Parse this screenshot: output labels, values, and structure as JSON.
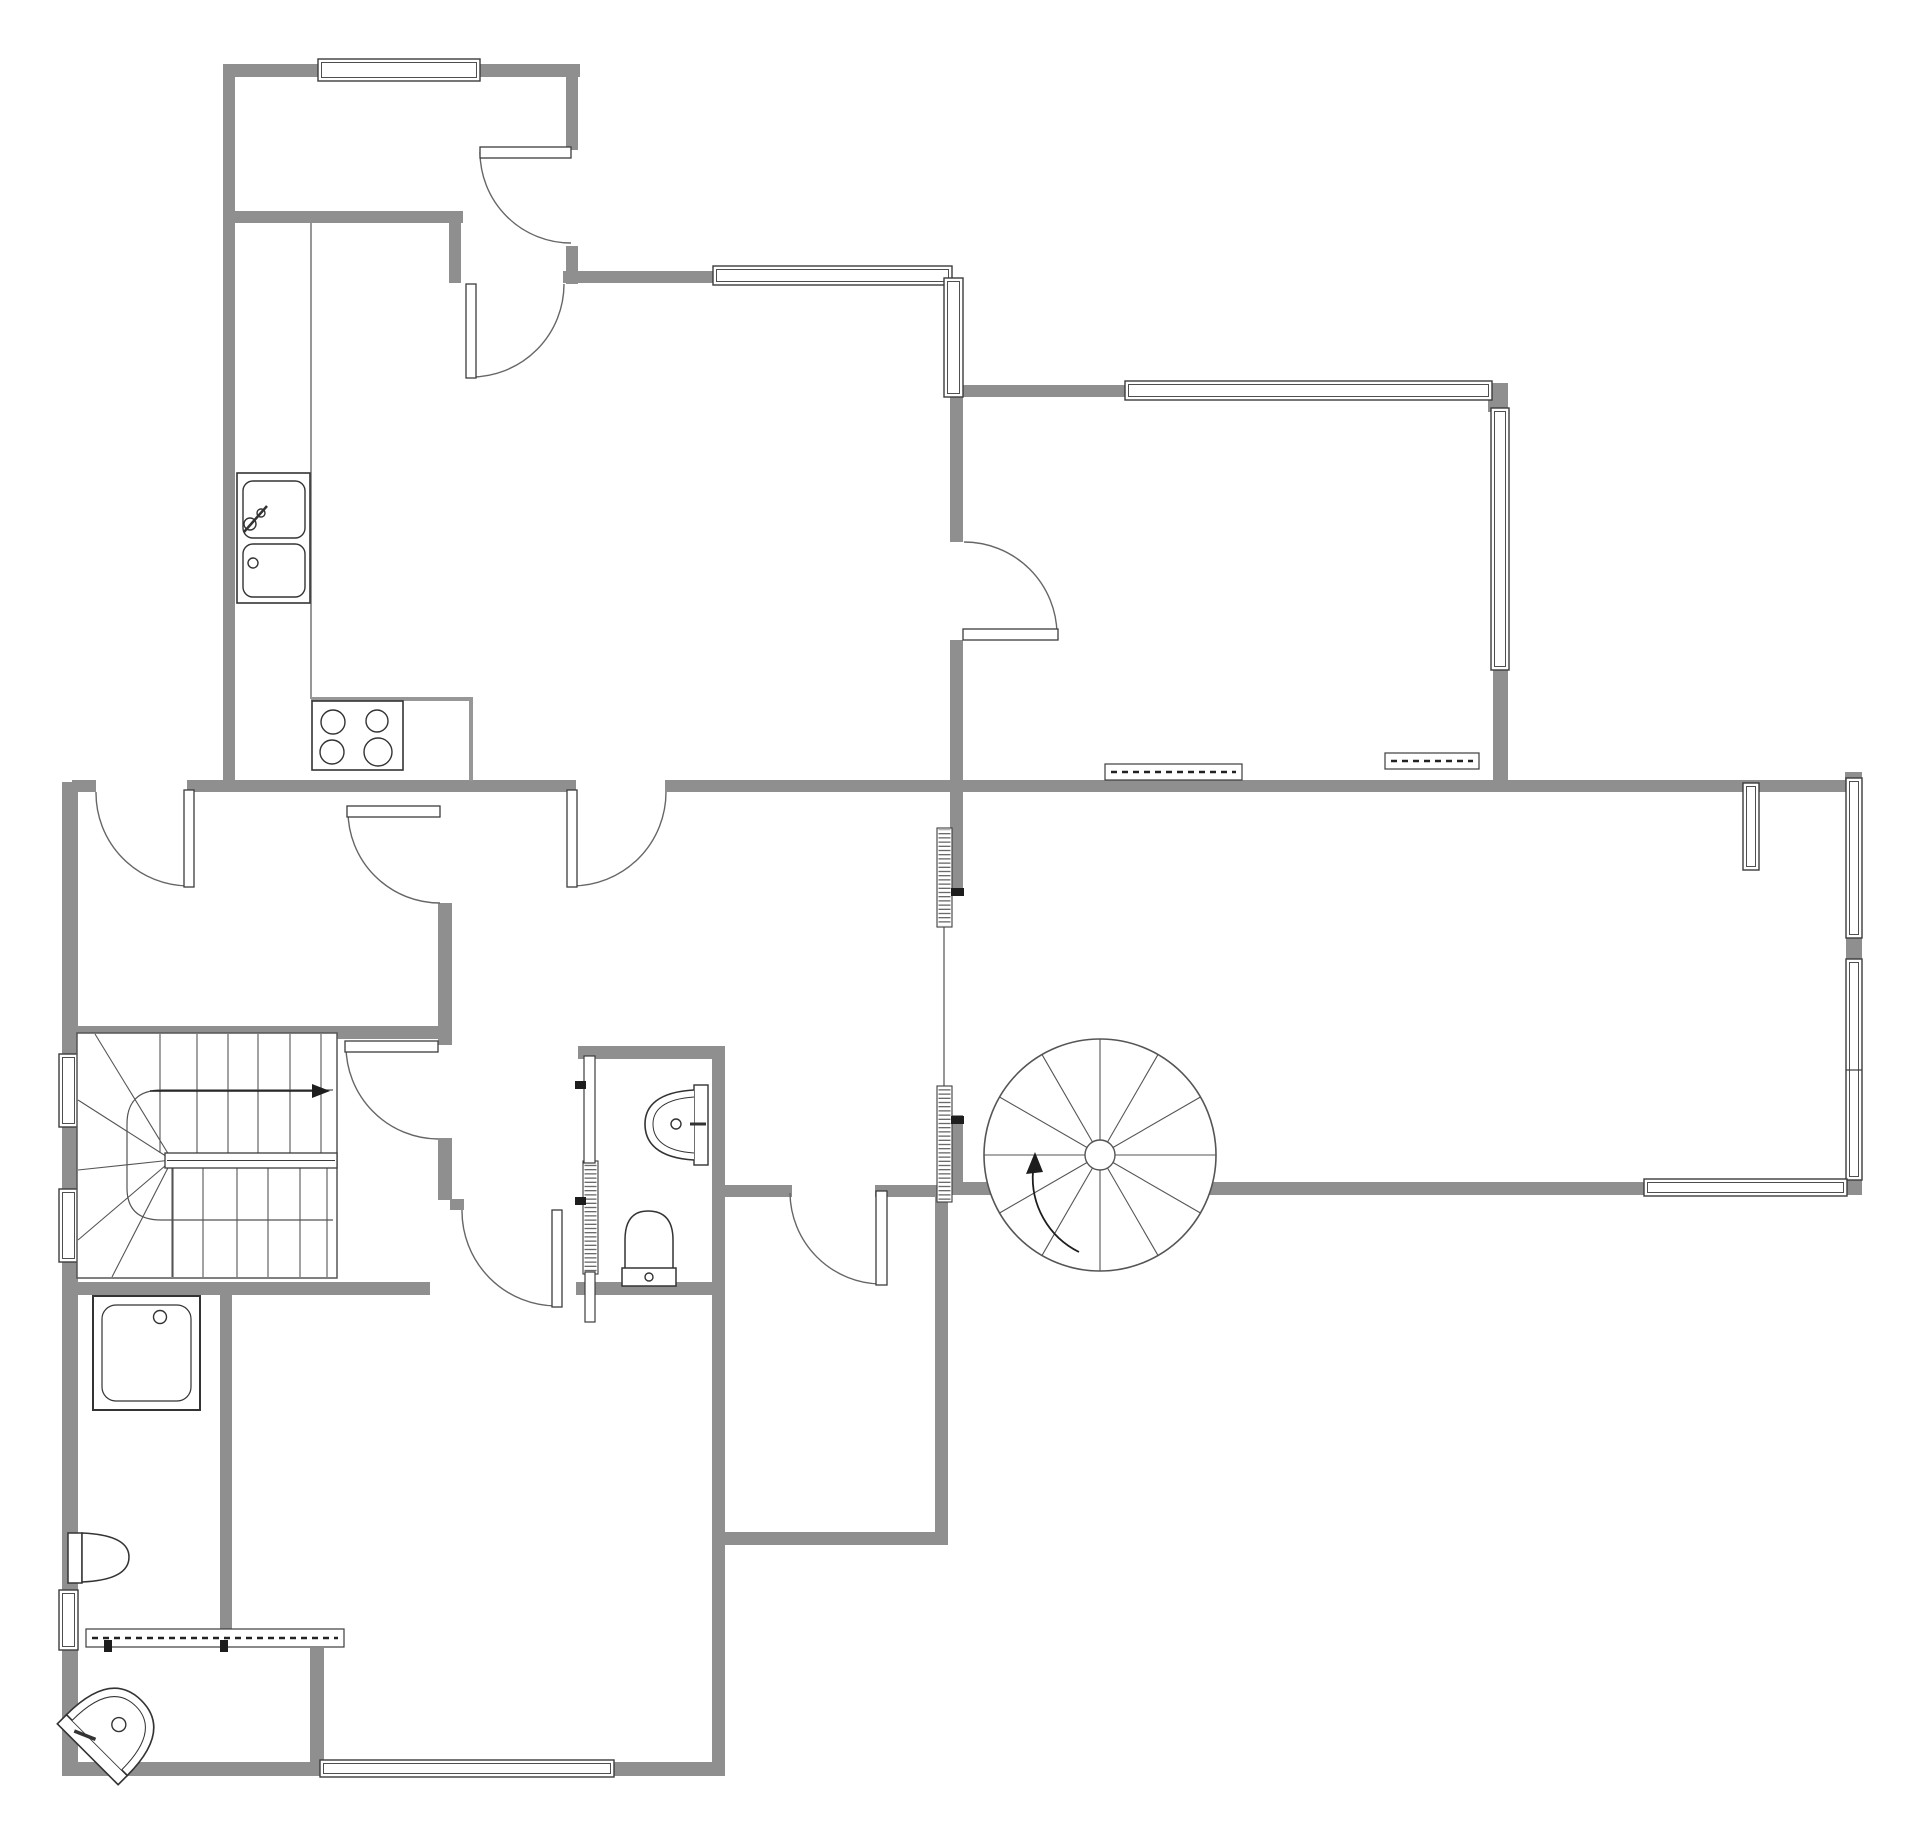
{
  "meta": {
    "title": "floor-plan",
    "canvas": {
      "width": 1920,
      "height": 1840,
      "background": "#ffffff"
    },
    "colors": {
      "wall": "#8f8f8f",
      "outline": "#3c3c3c",
      "swing": "#666666",
      "thin": "#979797",
      "fixture": "#333333",
      "mark": "#1d1d1d"
    }
  },
  "plan": {
    "walls": [
      [
        "wall-topleft-top",
        223,
        64,
        357,
        13
      ],
      [
        "wall-entry-south",
        223,
        211,
        240,
        12
      ],
      [
        "wall-kitchen-north",
        563,
        271,
        155,
        12
      ],
      [
        "wall-topright-north",
        947,
        385,
        180,
        12
      ],
      [
        "wall-mid-west-stub",
        72,
        780,
        24,
        12
      ],
      [
        "wall-mid-main",
        187,
        780,
        389,
        12
      ],
      [
        "wall-mid-east",
        665,
        780,
        1191,
        12
      ],
      [
        "wall-stair-north",
        62,
        1026,
        390,
        13
      ],
      [
        "wall-bath-north",
        578,
        1046,
        147,
        13
      ],
      [
        "wall-bigroom-south",
        948,
        1182,
        908,
        13
      ],
      [
        "wall-strip-south-a",
        718,
        1185,
        74,
        12
      ],
      [
        "wall-strip-south-b",
        875,
        1185,
        75,
        12
      ],
      [
        "wall-stair-south",
        62,
        1282,
        368,
        13
      ],
      [
        "wall-bath-south",
        576,
        1282,
        149,
        13
      ],
      [
        "wall-midroom-south",
        712,
        1532,
        236,
        13
      ],
      [
        "wall-bottom-west",
        62,
        1762,
        262,
        14
      ],
      [
        "wall-bottom-east",
        608,
        1762,
        116,
        14
      ],
      [
        "wall-corridor-stub",
        450,
        1199,
        14,
        11
      ],
      [
        "wall-kitchen-west",
        223,
        64,
        12,
        728
      ],
      [
        "wall-entry-east-a",
        566,
        64,
        12,
        86
      ],
      [
        "wall-entry-east-b",
        566,
        246,
        12,
        38
      ],
      [
        "wall-entry-corner",
        449,
        211,
        12,
        72
      ],
      [
        "wall-kitchen-east-a",
        950,
        395,
        13,
        147
      ],
      [
        "wall-kitchen-east-b",
        950,
        640,
        13,
        255
      ],
      [
        "wall-bigroom-west-low",
        950,
        1115,
        13,
        75
      ],
      [
        "wall-topright-ne-corner",
        1488,
        383,
        20,
        29
      ],
      [
        "wall-topright-east",
        1493,
        668,
        15,
        124
      ],
      [
        "wall-bigroom-ne-corner",
        1845,
        772,
        17,
        10
      ],
      [
        "wall-bigroom-east-a",
        1846,
        936,
        16,
        27
      ],
      [
        "wall-bigroom-east-b",
        1846,
        1176,
        16,
        19
      ],
      [
        "wall-west-a",
        62,
        782,
        16,
        276
      ],
      [
        "wall-west-b",
        62,
        1123,
        16,
        70
      ],
      [
        "wall-west-c",
        62,
        1258,
        16,
        336
      ],
      [
        "wall-west-d",
        62,
        1644,
        16,
        132
      ],
      [
        "wall-hall-east-a",
        438,
        903,
        14,
        142
      ],
      [
        "wall-hall-east-b",
        438,
        1138,
        14,
        62
      ],
      [
        "wall-rooms-divider",
        712,
        1046,
        13,
        730
      ],
      [
        "wall-midroom-east",
        935,
        1193,
        13,
        352
      ],
      [
        "wall-wc-east",
        220,
        1288,
        12,
        342
      ],
      [
        "wall-sinkroom-east",
        310,
        1648,
        14,
        128
      ]
    ],
    "thin_lines": [
      [
        "kitchen-zone-line",
        311,
        223,
        311,
        699,
        2
      ],
      [
        "bigroom-west-line",
        944,
        925,
        944,
        1087,
        2
      ]
    ],
    "counter_path": {
      "name": "kitchen-counter",
      "d": "M311,699 H471 V781",
      "sw": 4
    },
    "windows": [
      [
        "window-entry-north",
        318,
        59,
        162,
        22
      ],
      [
        "window-kitchen-north",
        713,
        266,
        239,
        19
      ],
      [
        "window-kitchen-east",
        944,
        278,
        19,
        119
      ],
      [
        "window-topright-north",
        1125,
        381,
        367,
        19
      ],
      [
        "window-topright-east",
        1491,
        408,
        18,
        262
      ],
      [
        "window-bigroom-east-1",
        1846,
        778,
        16,
        160
      ],
      [
        "window-bigroom-east-2",
        1846,
        959,
        16,
        221
      ],
      [
        "window-bigroom-south",
        1644,
        1179,
        203,
        17
      ],
      [
        "window-west-1",
        59,
        1054,
        19,
        73
      ],
      [
        "window-west-2",
        59,
        1189,
        19,
        73
      ],
      [
        "window-west-3",
        59,
        1590,
        19,
        60
      ],
      [
        "window-bottom",
        320,
        1760,
        294,
        17
      ],
      [
        "window-bigroom-radiator",
        1743,
        783,
        16,
        87
      ]
    ],
    "dashed_windows": [
      [
        "radiator-topright-1",
        1105,
        764,
        137,
        16
      ],
      [
        "radiator-topright-2",
        1385,
        753,
        94,
        16
      ],
      [
        "radiator-sinkroom",
        86,
        1629,
        258,
        18
      ]
    ],
    "hatched_panels": [
      [
        "glazed-panel-bigroom-1",
        937,
        828,
        15,
        99
      ],
      [
        "glazed-panel-bigroom-2",
        937,
        1086,
        15,
        116
      ],
      [
        "glazed-panel-bath",
        583,
        1161,
        15,
        113
      ]
    ],
    "white_panels": [
      [
        "bath-partition-top",
        584,
        1056,
        11,
        107
      ],
      [
        "bath-partition-bottom",
        585,
        1272,
        10,
        50
      ]
    ],
    "ticks": [
      [
        "tick-bath-1",
        575,
        1081,
        11,
        8
      ],
      [
        "tick-bath-2",
        575,
        1197,
        11,
        8
      ],
      [
        "tick-bigroom-1",
        951,
        888,
        13,
        8
      ],
      [
        "tick-bigroom-2",
        951,
        1116,
        13,
        8
      ],
      [
        "tick-sinkroom-1",
        104,
        1640,
        8,
        12
      ],
      [
        "tick-sinkroom-2",
        220,
        1640,
        8,
        12
      ]
    ],
    "doors": [
      {
        "name": "door-entry-exterior",
        "leaf": [
          480,
          147,
          91,
          11
        ],
        "arc": "M480,152 A91,91 0 0 0 571,243"
      },
      {
        "name": "door-entry-kitchen",
        "leaf": [
          466,
          284,
          10,
          94
        ],
        "arc": "M471,377 A93,93 0 0 0 564,284"
      },
      {
        "name": "door-hall-exterior",
        "leaf": [
          184,
          790,
          10,
          97
        ],
        "arc": "M189,886 A93,93 0 0 1 96,792"
      },
      {
        "name": "door-hall-corridor",
        "leaf": [
          347,
          806,
          93,
          11
        ],
        "arc": "M348,811 A92,92 0 0 0 440,903"
      },
      {
        "name": "door-kitchen-dining",
        "leaf": [
          567,
          790,
          10,
          97
        ],
        "arc": "M572,886 A94,94 0 0 0 666,792"
      },
      {
        "name": "door-kitchen-topright",
        "leaf": [
          963,
          629,
          95,
          11
        ],
        "arc": "M1057,634 A93,93 0 0 0 964,542"
      },
      {
        "name": "door-corridor-stairroom",
        "leaf": [
          345,
          1041,
          93,
          11
        ],
        "arc": "M346,1046 A93,93 0 0 0 438,1139"
      },
      {
        "name": "door-corridor-bottomroom",
        "leaf": [
          552,
          1210,
          10,
          97
        ],
        "arc": "M557,1306 A95,95 0 0 1 462,1210"
      },
      {
        "name": "door-dining-midroom",
        "leaf": [
          876,
          1191,
          11,
          94
        ],
        "arc": "M881,1284 A92,92 0 0 1 790,1193"
      }
    ],
    "stairs": {
      "name": "staircase-straight",
      "box": [
        77,
        1033,
        260,
        245
      ],
      "upper_treads": {
        "xs": [
          160,
          197,
          228,
          258,
          290,
          321
        ],
        "y1": 1034,
        "y2": 1153
      },
      "landing": [
        165,
        1153,
        172,
        15
      ],
      "lower_treads": {
        "xs": [
          173,
          203,
          237,
          268,
          300,
          327
        ],
        "y1": 1168,
        "y2": 1277
      },
      "fan_center": [
        172,
        1160
      ],
      "fan_points": [
        [
          95,
          1034
        ],
        [
          78,
          1100
        ],
        [
          78,
          1170
        ],
        [
          78,
          1240
        ],
        [
          112,
          1277
        ],
        [
          172,
          1277
        ]
      ],
      "rail_path": "M333,1090 H162 Q127,1090 127,1124 V1188 Q127,1220 161,1220 H333",
      "arrow": {
        "x1": 150,
        "y1": 1091,
        "x2": 312,
        "y2": 1091,
        "head": "312,1084 330,1091 312,1098"
      }
    },
    "spiral": {
      "name": "staircase-spiral",
      "cx": 1100,
      "cy": 1155,
      "r": 116,
      "hub_r": 15,
      "spokes": 12,
      "arrow_path": "M1079,1252 A83,83 0 0 1 1033,1171",
      "arrow_head": "1035,1152 1026,1174 1043,1172"
    },
    "fixtures": [
      {
        "name": "fixture-kitchen-sink",
        "shapes": [
          {
            "t": "rect",
            "x": 237,
            "y": 473,
            "w": 73,
            "h": 130,
            "sw": 1.6
          },
          {
            "t": "rrect",
            "x": 243,
            "y": 481,
            "w": 62,
            "h": 57,
            "rx": 10
          },
          {
            "t": "rrect",
            "x": 243,
            "y": 544,
            "w": 62,
            "h": 53,
            "rx": 10
          },
          {
            "t": "circle",
            "cx": 250,
            "cy": 524,
            "r": 6
          },
          {
            "t": "circle",
            "cx": 261,
            "cy": 513,
            "r": 4
          },
          {
            "t": "line",
            "x1": 244,
            "y1": 532,
            "x2": 267,
            "y2": 506,
            "sw": 2.5
          },
          {
            "t": "circle",
            "cx": 253,
            "cy": 563,
            "r": 5
          }
        ]
      },
      {
        "name": "fixture-stove",
        "shapes": [
          {
            "t": "rect",
            "x": 312,
            "y": 701,
            "w": 91,
            "h": 69,
            "sw": 1.6
          },
          {
            "t": "circle",
            "cx": 333,
            "cy": 722,
            "r": 12
          },
          {
            "t": "circle",
            "cx": 377,
            "cy": 721,
            "r": 11
          },
          {
            "t": "circle",
            "cx": 332,
            "cy": 752,
            "r": 12
          },
          {
            "t": "circle",
            "cx": 378,
            "cy": 752,
            "r": 14
          }
        ]
      },
      {
        "name": "fixture-bath-sink",
        "shapes": [
          {
            "t": "rect",
            "x": 694,
            "y": 1085,
            "w": 14,
            "h": 80,
            "sw": 1.4
          },
          {
            "t": "path",
            "d": "M694,1090 C658,1092 645,1106 645,1124 C645,1143 658,1158 694,1160",
            "sw": 1.6
          },
          {
            "t": "path",
            "d": "M694,1097 C664,1099 653,1110 653,1124 C653,1139 664,1151 694,1153",
            "sw": 1
          },
          {
            "t": "circle",
            "cx": 676,
            "cy": 1124,
            "r": 5
          },
          {
            "t": "line",
            "x1": 690,
            "y1": 1124,
            "x2": 706,
            "y2": 1124,
            "sw": 3
          }
        ]
      },
      {
        "name": "fixture-bath-toilet",
        "shapes": [
          {
            "t": "path",
            "d": "M625,1270 V1240 Q625,1211 648,1211 Q673,1211 673,1240 V1270 Z",
            "sw": 1.5
          },
          {
            "t": "rect",
            "x": 622,
            "y": 1268,
            "w": 54,
            "h": 18,
            "sw": 1.5
          },
          {
            "t": "circle",
            "cx": 649,
            "cy": 1277,
            "r": 4
          }
        ]
      },
      {
        "name": "fixture-wc-toilet",
        "shapes": [
          {
            "t": "rect",
            "x": 68,
            "y": 1533,
            "w": 14,
            "h": 50,
            "sw": 1.5
          },
          {
            "t": "path",
            "d": "M82,1533 Q129,1535 129,1557 Q129,1580 82,1582 Z",
            "sw": 1.5
          }
        ]
      },
      {
        "name": "fixture-corner-basin",
        "tf": "translate(116,1726) rotate(45)",
        "shapes": [
          {
            "t": "rect",
            "x": -43,
            "y": 27,
            "w": 86,
            "h": 13,
            "sw": 1.6
          },
          {
            "t": "path",
            "d": "M-43,27 Q-43,-36 0,-36 Q43,-36 43,27 Z",
            "sw": 1.6
          },
          {
            "t": "path",
            "d": "M-35,27 Q-35,-28 0,-28 Q35,-28 35,27",
            "sw": 1
          },
          {
            "t": "circle",
            "cx": 1,
            "cy": -3,
            "r": 7
          },
          {
            "t": "line",
            "x1": -26,
            "y1": 33,
            "x2": -5,
            "y2": 24,
            "sw": 3.5
          }
        ]
      },
      {
        "name": "fixture-shower",
        "shapes": [
          {
            "t": "rect",
            "x": 93,
            "y": 1296,
            "w": 107,
            "h": 114,
            "sw": 2
          },
          {
            "t": "rrect",
            "x": 102,
            "y": 1305,
            "w": 89,
            "h": 96,
            "rx": 14,
            "sw": 1.2
          },
          {
            "t": "circle",
            "cx": 160,
            "cy": 1317,
            "r": 6.5
          }
        ]
      }
    ]
  }
}
